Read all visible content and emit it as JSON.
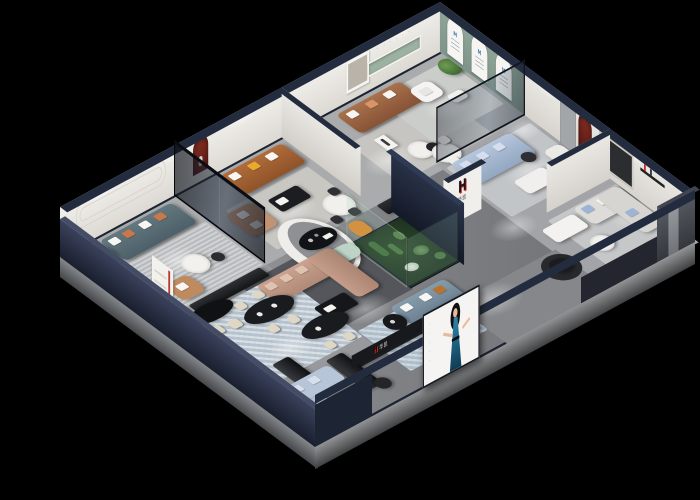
{
  "palette": {
    "background": "#000000",
    "brand-red": "#d8251f",
    "navy": "#232c3e",
    "navy-dark": "#171d2b",
    "wall-white": "#efede9",
    "sage-green": "#93a89a",
    "arch-red": "#7b2a22",
    "floor-grey": "#8e9093",
    "glass-tint": "rgba(14,19,30,0.62)",
    "logo-blue": "#3d7ab3"
  },
  "branding": {
    "logo_letter": "H",
    "logo_name": "华凯",
    "storefront_logo_letter": "H",
    "storefront_logo_name": "华凯",
    "arch_card_mark": "M"
  },
  "wall_text": {
    "letters_plaque": "· · · · · ·",
    "billboard_side_text": "· · · · ·"
  }
}
